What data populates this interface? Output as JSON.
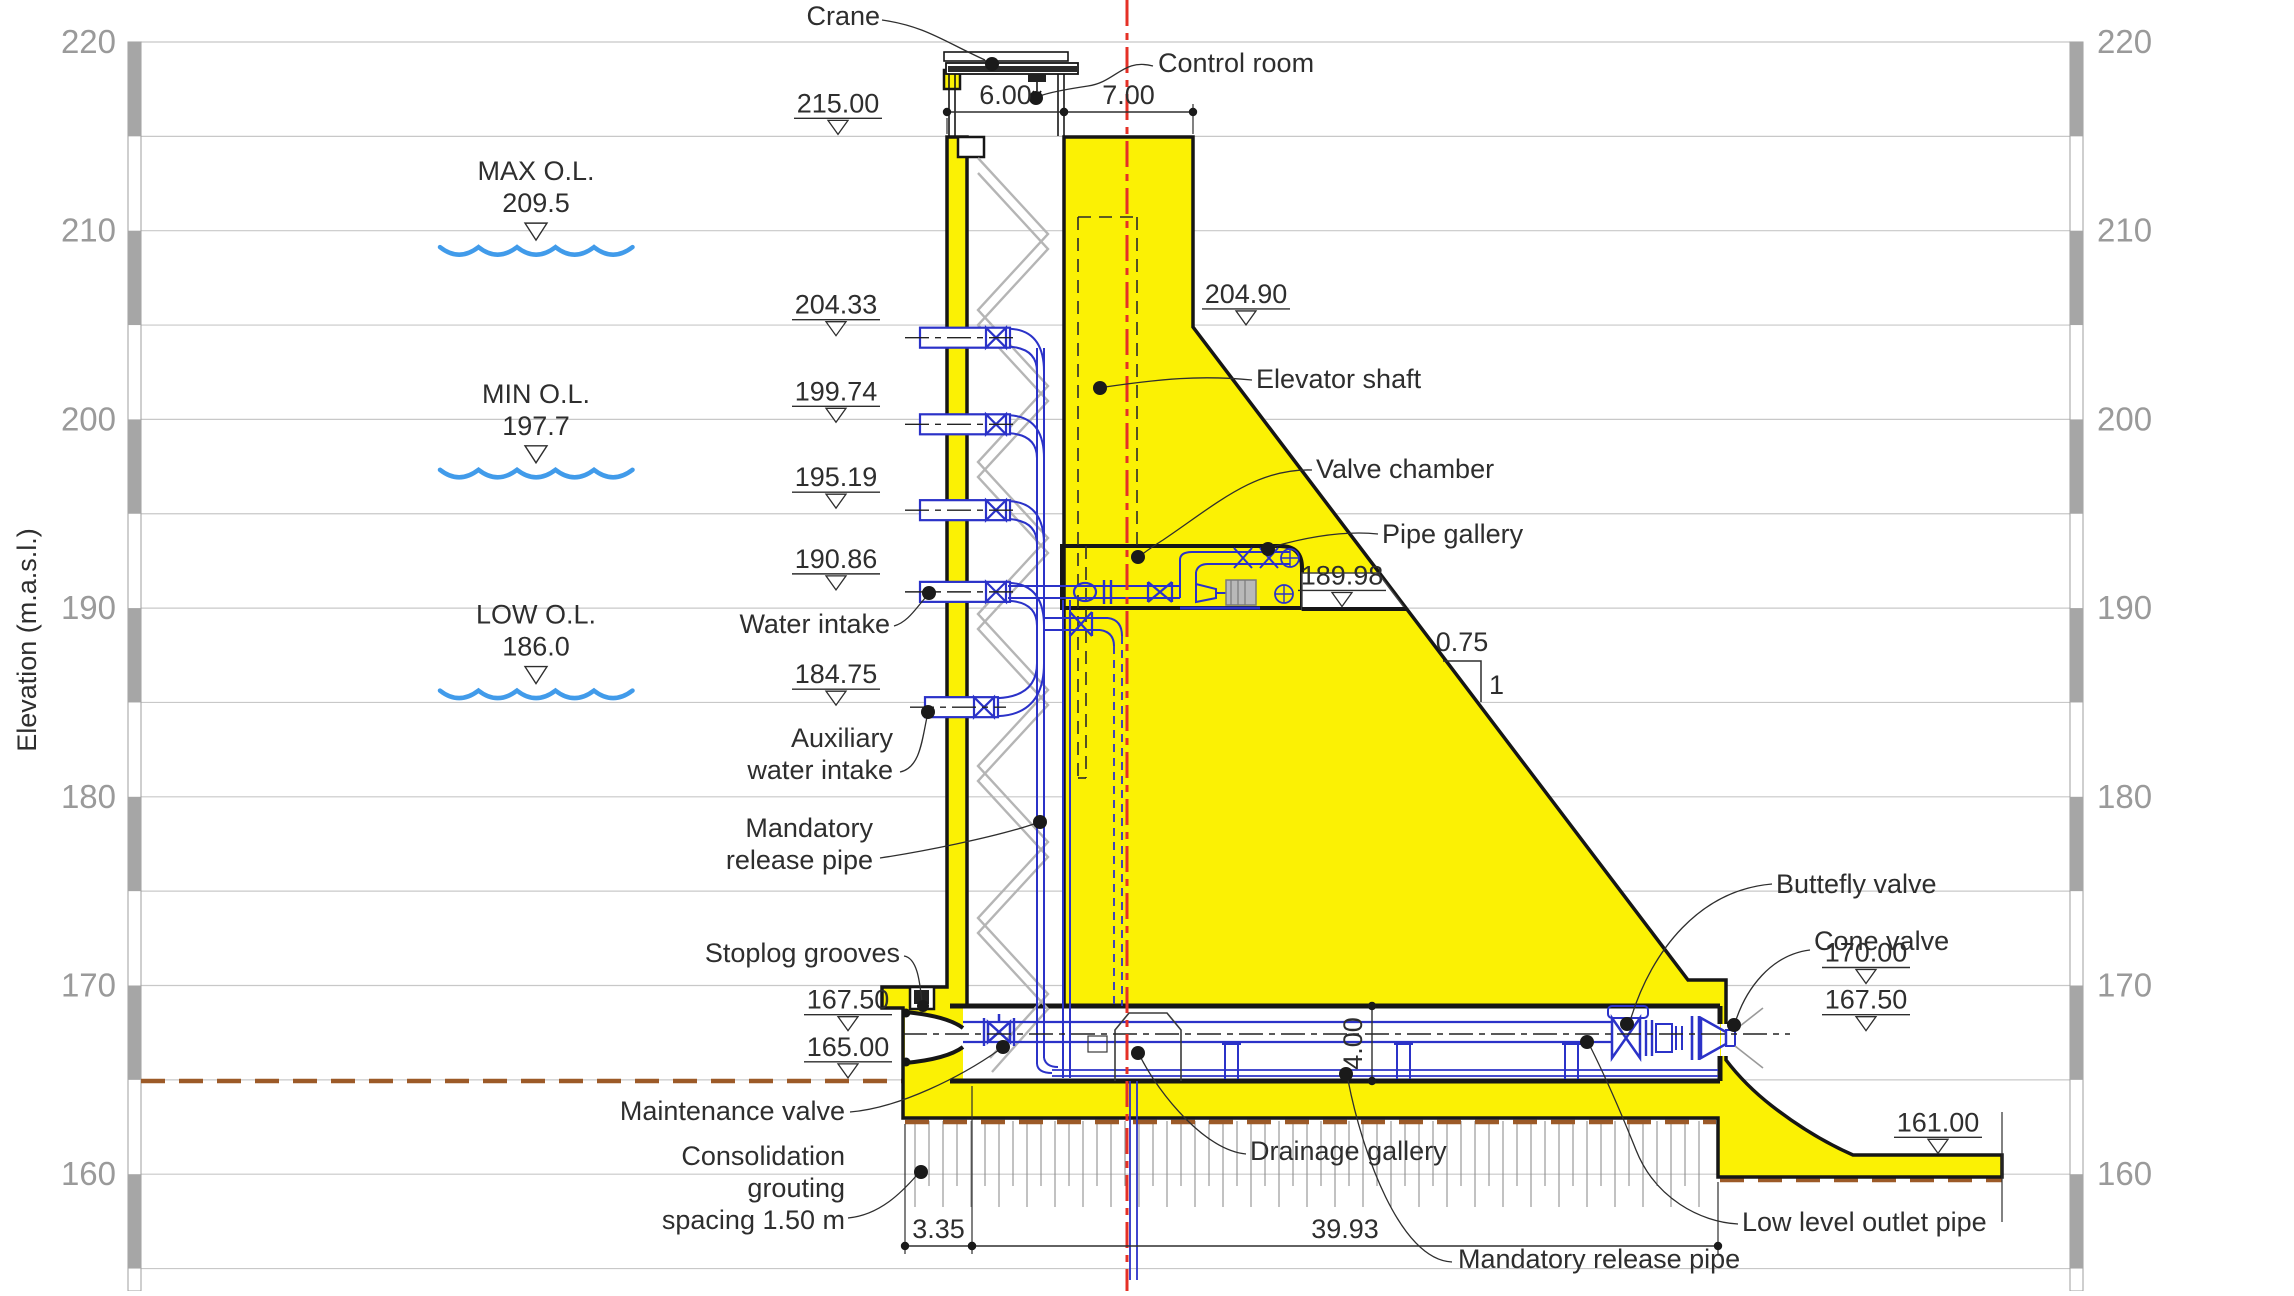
{
  "drawing_title": "Dam cross-section with intake tower and bottom outlet",
  "colors": {
    "concrete_yellow": "#fbf104",
    "outline_black": "#161616",
    "pipe_blue": "#2b32c8",
    "water_blue": "#419bea",
    "centerline_red": "#e53026",
    "ground_brown": "#9c5a28",
    "grid_gray": "#c8c8c8",
    "axis_text_gray": "#9a9a9a"
  },
  "axis": {
    "label": "Elevation (m.a.s.l.)",
    "unit": "m.a.s.l.",
    "y_at_220": 42,
    "px_per_m": 18.87,
    "grid_elevations": [
      220,
      215,
      210,
      205,
      200,
      195,
      190,
      185,
      180,
      175,
      170,
      165,
      160,
      155
    ],
    "tick_labels": [
      220,
      210,
      200,
      190,
      180,
      170,
      160
    ],
    "plot_x1": 141,
    "plot_x2": 2070,
    "bar_left_x": 128,
    "bar_right_x": 2070,
    "bar_width": 13
  },
  "water_levels": [
    {
      "name": "MAX O.L.",
      "value": "209.5",
      "elev": 209.5,
      "cx": 536
    },
    {
      "name": "MIN O.L.",
      "value": "197.7",
      "elev": 197.7,
      "cx": 536
    },
    {
      "name": "LOW O.L.",
      "value": "186.0",
      "elev": 186.0,
      "cx": 536
    }
  ],
  "level_markers": [
    {
      "text": "215.00",
      "cx": 838,
      "elev": 215.0
    },
    {
      "text": "204.33",
      "cx": 836,
      "elev": 204.33
    },
    {
      "text": "199.74",
      "cx": 836,
      "elev": 199.74
    },
    {
      "text": "195.19",
      "cx": 836,
      "elev": 195.19
    },
    {
      "text": "190.86",
      "cx": 836,
      "elev": 190.86
    },
    {
      "text": "184.75",
      "cx": 836,
      "elev": 184.75
    },
    {
      "text": "204.90",
      "cx": 1246,
      "elev": 204.9
    },
    {
      "text": "189.98",
      "cx": 1342,
      "elev": 189.98
    },
    {
      "text": "167.50",
      "cx": 848,
      "elev": 167.5
    },
    {
      "text": "165.00",
      "cx": 848,
      "elev": 165.0
    },
    {
      "text": "170.00",
      "cx": 1866,
      "elev": 170.0
    },
    {
      "text": "167.50",
      "cx": 1866,
      "elev": 167.5
    },
    {
      "text": "161.00",
      "cx": 1938,
      "elev": 161.0
    }
  ],
  "dimensions_h": [
    {
      "label": "6.00",
      "x1": 947,
      "x2": 1064,
      "y": 112
    },
    {
      "label": "7.00",
      "x1": 1064,
      "x2": 1193,
      "y": 112
    },
    {
      "label": "3.35",
      "x1": 905,
      "x2": 972,
      "y": 1246
    },
    {
      "label": "39.93",
      "x1": 972,
      "x2": 1718,
      "y": 1246
    }
  ],
  "dimensions_v": [
    {
      "label": "4.00",
      "x": 1372,
      "y1": 1006,
      "y2": 1081
    }
  ],
  "slope": {
    "horizontal": "0.75",
    "vertical": "1"
  },
  "callouts": [
    {
      "name": "crane-label",
      "lines": [
        "Crane"
      ],
      "x": 880,
      "y": 25,
      "anchor": "end"
    },
    {
      "name": "control-room-label",
      "lines": [
        "Control room"
      ],
      "x": 1158,
      "y": 72,
      "anchor": "start"
    },
    {
      "name": "elevator-shaft-label",
      "lines": [
        "Elevator shaft"
      ],
      "x": 1256,
      "y": 388,
      "anchor": "start"
    },
    {
      "name": "valve-chamber-label",
      "lines": [
        "Valve chamber"
      ],
      "x": 1316,
      "y": 478,
      "anchor": "start"
    },
    {
      "name": "pipe-gallery-label",
      "lines": [
        "Pipe gallery"
      ],
      "x": 1382,
      "y": 543,
      "anchor": "start"
    },
    {
      "name": "water-intake-label",
      "lines": [
        "Water intake"
      ],
      "x": 890,
      "y": 633,
      "anchor": "end"
    },
    {
      "name": "auxiliary-water-intake-label",
      "lines": [
        "Auxiliary",
        "water intake"
      ],
      "x": 893,
      "y": 747,
      "anchor": "end"
    },
    {
      "name": "mandatory-release-pipe-left-label",
      "lines": [
        "Mandatory",
        "release pipe"
      ],
      "x": 873,
      "y": 837,
      "anchor": "end"
    },
    {
      "name": "stoplog-grooves-label",
      "lines": [
        "Stoplog grooves"
      ],
      "x": 900,
      "y": 962,
      "anchor": "end"
    },
    {
      "name": "maintenance-valve-label",
      "lines": [
        "Maintenance valve"
      ],
      "x": 845,
      "y": 1120,
      "anchor": "end"
    },
    {
      "name": "consolidation-grouting-label",
      "lines": [
        "Consolidation",
        "grouting",
        "spacing 1.50 m"
      ],
      "x": 845,
      "y": 1165,
      "anchor": "end"
    },
    {
      "name": "drainage-gallery-label",
      "lines": [
        "Drainage gallery"
      ],
      "x": 1250,
      "y": 1160,
      "anchor": "start"
    },
    {
      "name": "mandatory-release-pipe-bottom-label",
      "lines": [
        "Mandatory release pipe"
      ],
      "x": 1458,
      "y": 1268,
      "anchor": "start"
    },
    {
      "name": "low-level-outlet-pipe-label",
      "lines": [
        "Low level outlet pipe"
      ],
      "x": 1742,
      "y": 1231,
      "anchor": "start"
    },
    {
      "name": "butterfly-valve-label",
      "lines": [
        "Buttefly valve"
      ],
      "x": 1776,
      "y": 893,
      "anchor": "start"
    },
    {
      "name": "cone-valve-label",
      "lines": [
        "Cone valve"
      ],
      "x": 1814,
      "y": 950,
      "anchor": "start"
    }
  ]
}
